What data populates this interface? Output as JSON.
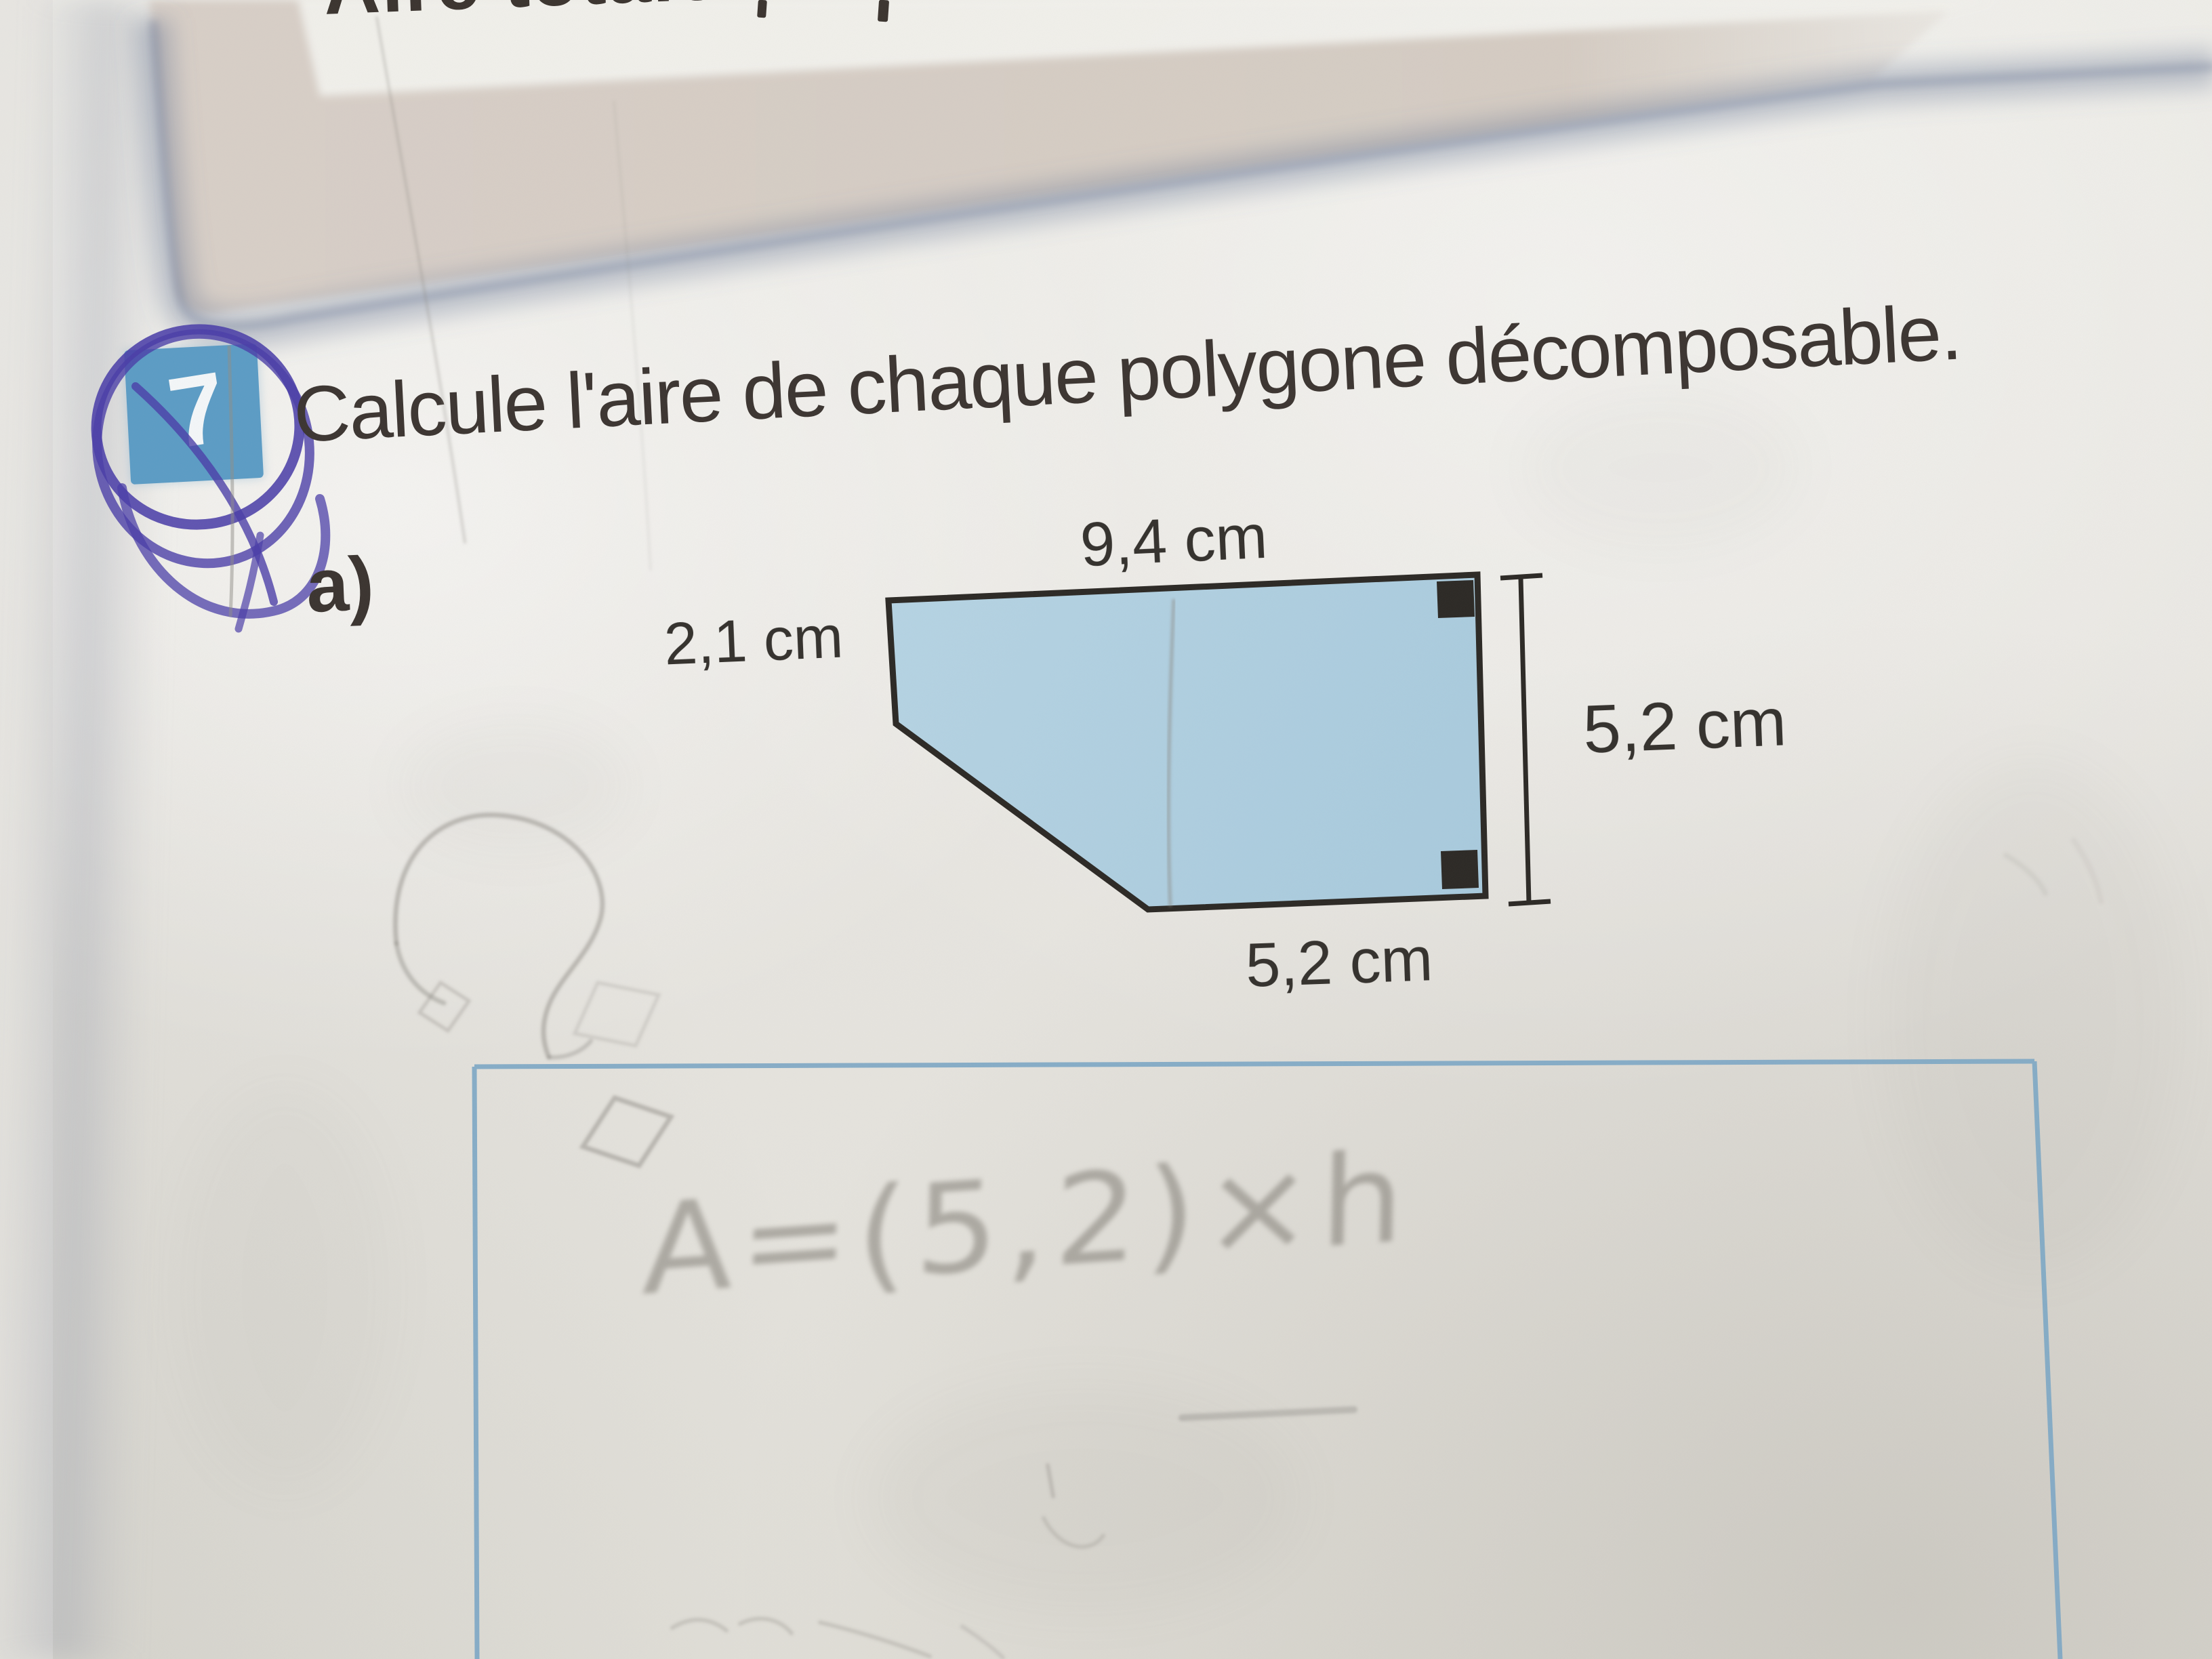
{
  "photo": {
    "kind": "photograph of a math workbook page",
    "header_fragment": "Aire totale",
    "question": {
      "badge_number": "7",
      "badge_color": "#5b9cc5",
      "pen_circle_color": "#4a3da8",
      "title": "Calcule l'aire de chaque polygone décomposable.",
      "item_label": "a)"
    },
    "figure": {
      "shape": "decomposable polygon (rectangle with cut corner, 5 sides)",
      "fill_color": "#aed0e1",
      "outline_color": "#2b2824",
      "top_label": "9,4 cm",
      "left_label": "2,1 cm",
      "right_label": "5,2 cm",
      "bottom_label": "5,2 cm",
      "right_angle_markers": 2,
      "dimension_line": "vertical tick-ended line along right side"
    },
    "handwriting": {
      "pencil_question_mark": "?",
      "erased_formula": "A=(5,2)×h"
    },
    "answer_box": {
      "border_color": "#7fa9c6"
    }
  }
}
